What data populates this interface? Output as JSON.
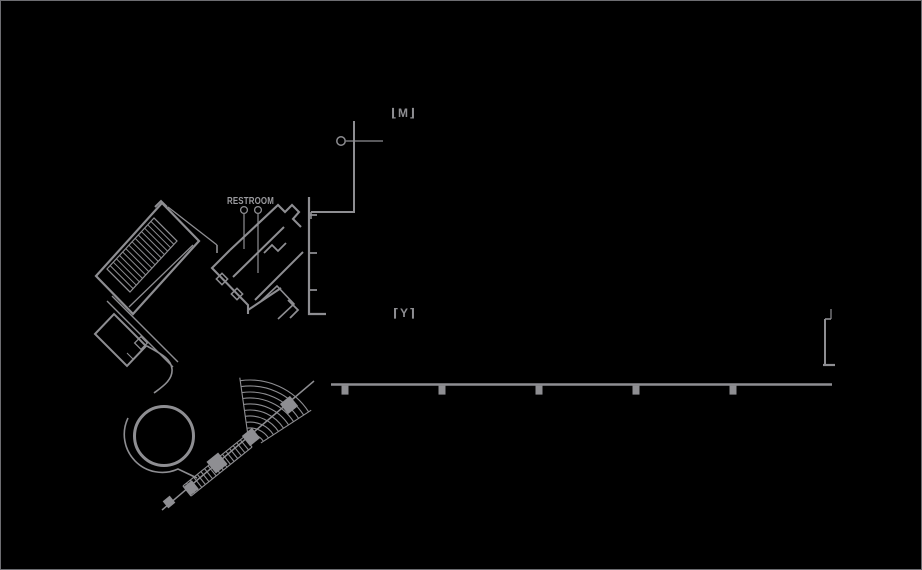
{
  "colors": {
    "bg": "#000000",
    "line": "#8e8e92",
    "text": "#9b9b9f",
    "border": "#6d6d71"
  },
  "floorplan": {
    "restroom_label": "RESTROOM",
    "markers": {
      "upper": {
        "glyph": "⌊M⌋"
      },
      "middle": {
        "glyph": "⌈Y⌉"
      }
    }
  }
}
